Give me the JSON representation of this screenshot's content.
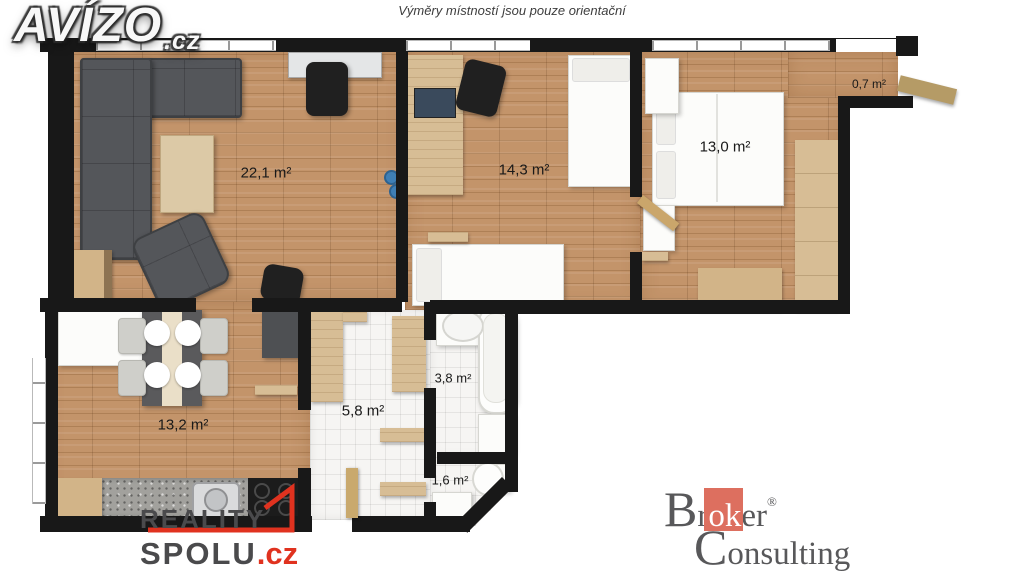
{
  "header": {
    "disclaimer": "Výměry místností jsou pouze orientační"
  },
  "logos": {
    "avizo": {
      "name": "AVÍZO",
      "tld": ".cz"
    },
    "reality_spolu": {
      "word1": "REALITY",
      "word2": "SPOLU",
      "tld": ".cz",
      "accent_color": "#e0321f"
    },
    "broker_consulting": {
      "br": "Br",
      "ok": "ok",
      "er": "er",
      "reg": "®",
      "line2": "Consulting",
      "accent_color": "#dd6f5f"
    }
  },
  "floor_plan": {
    "rooms": [
      {
        "id": "living-room",
        "area_label": "22,1 m²"
      },
      {
        "id": "bedroom-1",
        "area_label": "14,3 m²"
      },
      {
        "id": "bedroom-2",
        "area_label": "13,0 m²"
      },
      {
        "id": "entry-nook",
        "area_label": "0,7 m²"
      },
      {
        "id": "kitchen-dining",
        "area_label": "13,2 m²"
      },
      {
        "id": "hallway",
        "area_label": "5,8 m²"
      },
      {
        "id": "bathroom",
        "area_label": "3,8 m²"
      },
      {
        "id": "wc",
        "area_label": "1,6 m²"
      }
    ],
    "colors": {
      "wall": "#181818",
      "wood_floor": "#c3946a",
      "tile_floor": "#f6f5f3",
      "upholstery": "#4f5154",
      "light_wood": "#d7bd95"
    }
  }
}
